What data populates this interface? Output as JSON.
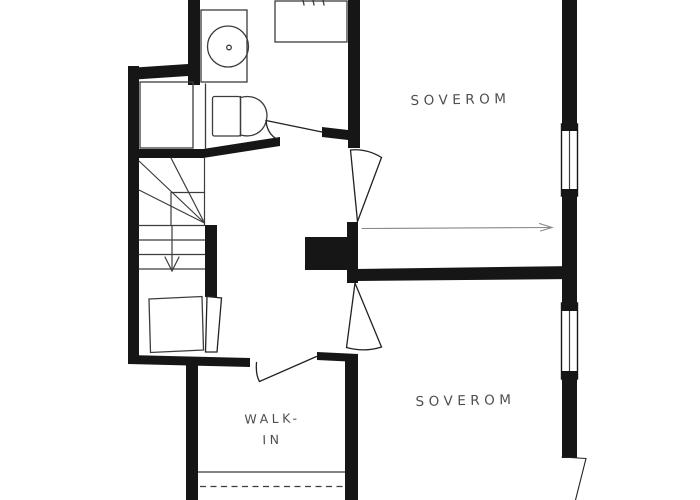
{
  "plan": {
    "type": "floor-plan",
    "colors": {
      "background": "#ffffff",
      "wall": "#161616",
      "thin_line": "#3c3c3c",
      "arrow_line": "#8a8a8a",
      "label_text": "#4e4e4e"
    },
    "rooms": {
      "bedroom_top": {
        "label": "SOVEROM"
      },
      "bedroom_bottom": {
        "label": "SOVEROM"
      },
      "walk_in": {
        "line1": "WALK-",
        "line2": "IN"
      }
    },
    "fixtures": {
      "bathroom": [
        "vanity-sink-icon",
        "toilet-icon",
        "shower-icon",
        "closet-niche"
      ],
      "stairs": "winder-staircase-down-arrow-icon",
      "windows": [
        "window-icon-bedroom-top",
        "window-icon-bedroom-bottom"
      ],
      "doors": [
        "bathroom-door-swing",
        "bedroom-top-door-swing",
        "bedroom-bottom-door-swing",
        "walk-in-door-swing",
        "stair-room-door-leaf",
        "exterior-door-swing"
      ],
      "other": [
        "chimney-block",
        "wardrobe-dashed-line",
        "direction-arrow"
      ]
    }
  }
}
